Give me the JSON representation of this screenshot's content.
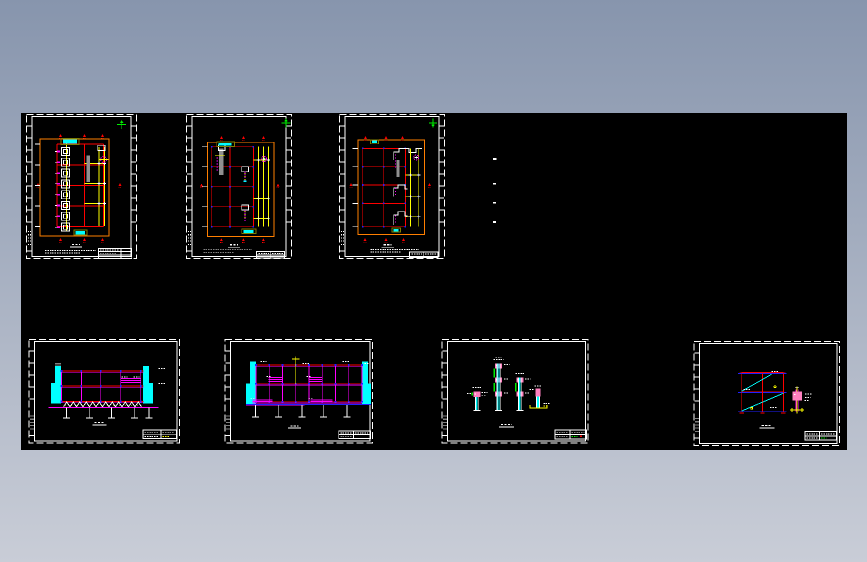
{
  "viewer": {
    "background": {
      "gradient_top": "#8795ad",
      "gradient_bottom": "#c9cdd7"
    },
    "canvas": {
      "x": 21,
      "y": 113,
      "width": 826,
      "height": 337,
      "background": "#000000"
    },
    "legibility": "all drawing annotation text is below rendering resolution (illegible micro-text)"
  },
  "colors": {
    "red": "#ff0000",
    "orange": "#ff7f00",
    "yellow": "#ffff00",
    "cyan": "#00ffff",
    "magenta": "#ff00ff",
    "white": "#ffffff",
    "blue": "#2020ff",
    "green": "#00ee00",
    "gray": "#909090",
    "olive": "#7f7f00",
    "pink": "#ff80c0",
    "canvas": "#000000",
    "bg_top": "#8795ad",
    "bg_bottom": "#c9cdd7"
  },
  "sheets": [
    {
      "id": "t1",
      "name": "floor-plan-sheet-1",
      "x": 5,
      "y": 1,
      "width": 111,
      "height": 145,
      "right_ticks": true
    },
    {
      "id": "t2",
      "name": "floor-plan-sheet-2",
      "x": 165,
      "y": 1,
      "width": 106,
      "height": 145,
      "right_ticks": true
    },
    {
      "id": "t3",
      "name": "floor-plan-sheet-3",
      "x": 318,
      "y": 1,
      "width": 106,
      "height": 145,
      "right_ticks": true
    },
    {
      "id": "b1",
      "name": "section-sheet-1",
      "x": 7.5,
      "y": 226,
      "width": 151.5,
      "height": 104.5,
      "right_ticks": false
    },
    {
      "id": "b2",
      "name": "section-sheet-2",
      "x": 203.5,
      "y": 226,
      "width": 148.5,
      "height": 104.5,
      "right_ticks": false
    },
    {
      "id": "b3",
      "name": "column-details-sheet",
      "x": 420.5,
      "y": 226,
      "width": 147,
      "height": 104.5,
      "right_ticks": false
    },
    {
      "id": "b4",
      "name": "frame-elevation-sheet",
      "x": 672.5,
      "y": 228,
      "width": 146.5,
      "height": 105,
      "right_ticks": false
    }
  ],
  "legend_marks": [
    {
      "x": 472,
      "y": 45.2,
      "w": 3.5,
      "h": 2
    },
    {
      "x": 472,
      "y": 69.8,
      "w": 3,
      "h": 1.6
    },
    {
      "x": 472,
      "y": 88.8,
      "w": 3,
      "h": 1.6
    },
    {
      "x": 472,
      "y": 108.2,
      "w": 3,
      "h": 1.6
    }
  ]
}
